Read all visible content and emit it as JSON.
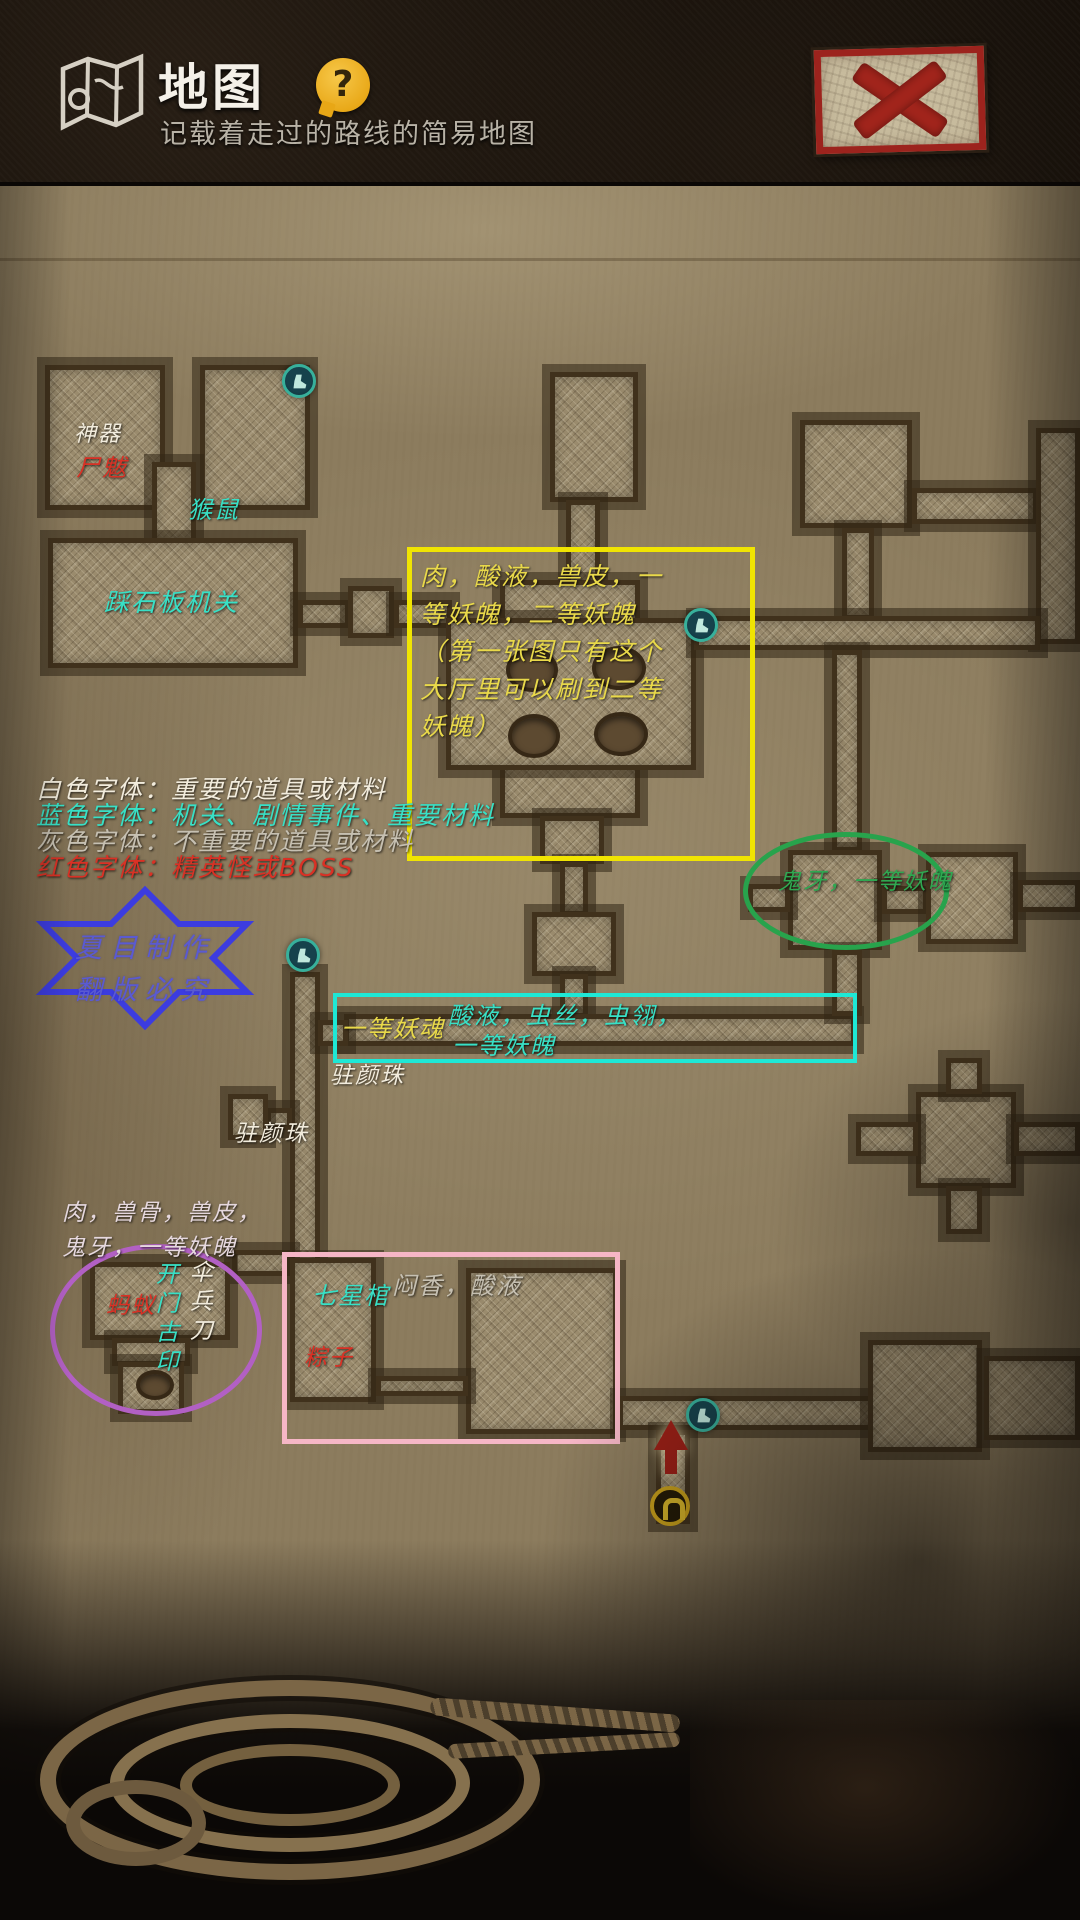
{
  "header": {
    "title": "地图",
    "subtitle": "记载着走过的路线的简易地图",
    "help": "?"
  },
  "close_button": {
    "icon_name": "red-x"
  },
  "legend": {
    "line1": "白色字体：重要的道具或材料",
    "line2": "蓝色字体：机关、剧情事件、重要材料",
    "line3": "灰色字体：不重要的道具或材料",
    "line4": "红色字体：精英怪或BOSS"
  },
  "watermark": {
    "line1": "夏目制作",
    "line2": "翻版必究"
  },
  "map_labels": {
    "artifact": "神器",
    "boss_top_left": "尸魃",
    "monkey_rat": "猴鼠",
    "stone_plate_trap": "踩石板机关",
    "hall_drops": "肉，酸液，兽皮，一等妖魄，二等妖魄（第一张图只有这个大厅里可以刷到二等妖魄）",
    "ghost_tooth_room": "鬼牙，一等妖魄",
    "corridor_left_drop": "一等妖魂",
    "corridor_drops_line1": "酸液，虫丝，虫翎，",
    "corridor_drops_line2": "一等妖魄",
    "beauty_pearl_1": "驻颜珠",
    "beauty_pearl_2": "驻颜珠",
    "west_room_drops": "肉，兽骨，兽皮，鬼牙，一等妖魄",
    "boss_west": "蚂蚁",
    "door_seal": "开门古印",
    "umbrella_knife": "伞兵刀",
    "seven_star_coffin": "七星棺",
    "coffin_room_drops": "闷香，酸液",
    "boss_coffin": "粽子"
  },
  "colors": {
    "white_label": "#f2ecdd",
    "cyan_label": "#38e0c6",
    "gray_label": "#c6c0b2",
    "red_label": "#d93125",
    "yellow_label": "#e9d94a",
    "green_label": "#2fa851",
    "yellow_box": "#f0e402",
    "cyan_box": "#1ee8d6",
    "pink_box": "#f6b6c6",
    "green_ellipse": "#28a34c",
    "purple_ellipse": "#b260c4",
    "star_blue": "#3c3ce0",
    "parchment": "#8c7c5e",
    "tile": "#9a8b6d"
  }
}
